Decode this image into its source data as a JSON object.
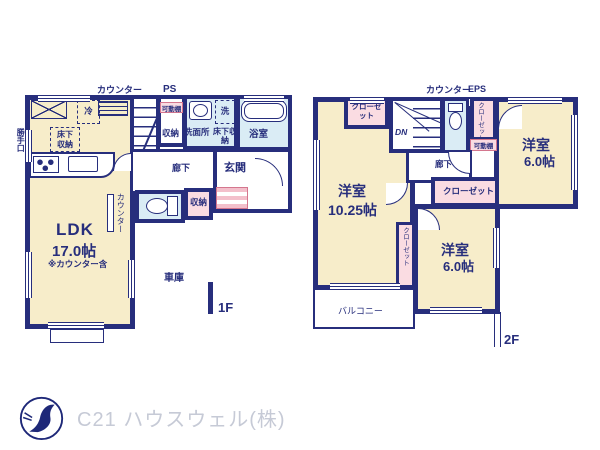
{
  "floor1": {
    "floor_label": "1F",
    "counter_top": "カウンター",
    "ps": "PS",
    "fridge": "冷",
    "back_door": "勝手口",
    "underfloor_ldk": "床下収納",
    "movable_shelf": "可動棚",
    "storage_stair": "収納",
    "washroom": "洗面所",
    "washer": "洗",
    "underfloor_wash": "床下収納",
    "bathroom": "浴室",
    "up": "UP",
    "hallway": "廊下",
    "storage_hall": "収納",
    "entrance": "玄関",
    "ldk_name": "LDK",
    "ldk_size": "17.0帖",
    "ldk_note": "※カウンター含",
    "counter_side": "カウンター",
    "garage": "車庫"
  },
  "floor2": {
    "floor_label": "2F",
    "counter_top": "カウンター",
    "eps": "EPS",
    "closet_top_left": "クローゼット",
    "dn": "DN",
    "closet_right": "クローゼット",
    "movable_shelf": "可動棚",
    "hallway": "廊下",
    "room_main": "洋室",
    "room_main_size": "10.25帖",
    "closet_mid": "クローゼット",
    "room_top_right": "洋室",
    "room_top_right_size": "6.0帖",
    "closet_between": "クローゼット",
    "room_bottom_right": "洋室",
    "room_bottom_right_size": "6.0帖",
    "balcony": "バルコニー"
  },
  "footer": {
    "company": "C21 ハウスウェル(株)"
  },
  "colors": {
    "wall_navy": "#272e7c",
    "room_cream": "#f7edca",
    "wet_area_blue": "#daecf5",
    "closet_pink": "#fadce2",
    "logo_text_gray": "#c6cad6"
  }
}
